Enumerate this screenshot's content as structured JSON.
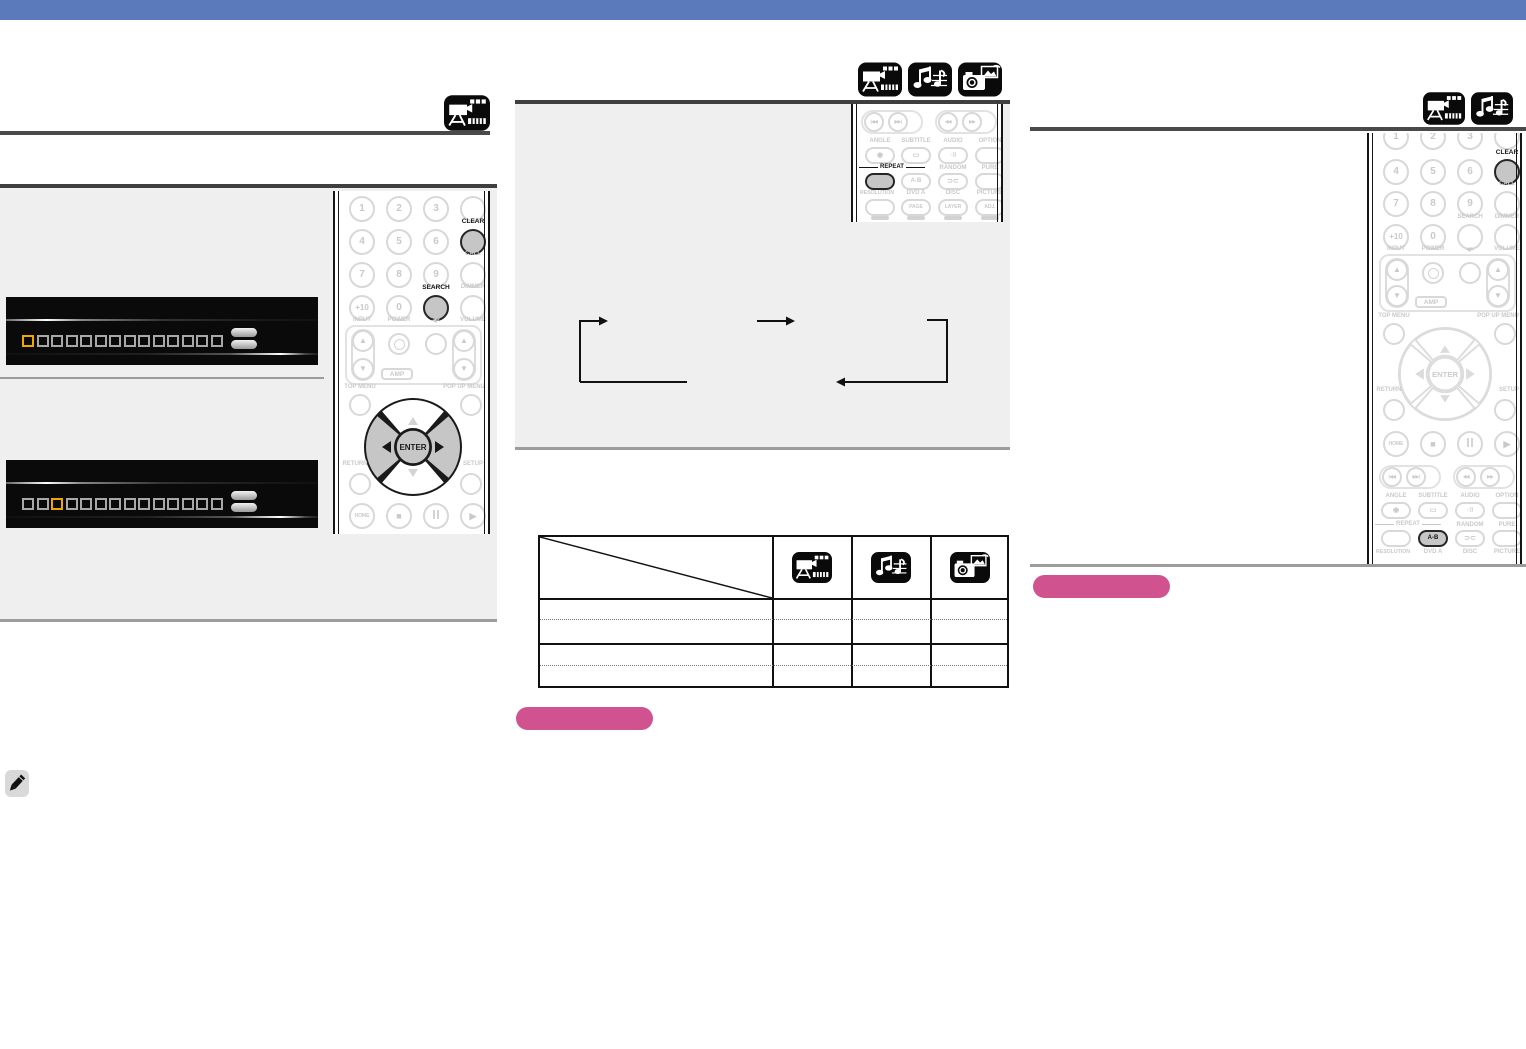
{
  "page": {
    "header_bar_color": "#5b7abc",
    "accent_pink": "#d0538f",
    "display_highlight_orange": "#f0a500"
  },
  "media_icons": {
    "left_section": [
      "dvd-video"
    ],
    "middle_section": [
      "dvd-video",
      "audio-cd",
      "picture"
    ],
    "right_section": [
      "dvd-video",
      "audio-cd"
    ]
  },
  "digits": [
    "1",
    "2",
    "3",
    "4",
    "5",
    "6",
    "7",
    "8",
    "9",
    "+10",
    "0"
  ],
  "remote_labels": {
    "clear": "CLEAR",
    "call": "CALL",
    "search": "SEARCH",
    "dimmer": "DIMMER",
    "input": "INPUT",
    "power": "POWER",
    "mute": "◀×",
    "volume": "VOLUME",
    "amp": "AMP",
    "top_menu": "TOP MENU",
    "popup_menu": "POP UP MENU",
    "enter": "ENTER",
    "return": "RETURN",
    "setup": "SETUP",
    "home": "HOME",
    "stop": "■",
    "play": "▶",
    "skip_back": "|◀◀",
    "skip_fwd": "▶▶|",
    "rew": "◀◀",
    "ffwd": "▶▶",
    "up": "▲",
    "down": "▼",
    "angle": "ANGLE",
    "subtitle": "SUBTITLE",
    "audio": "AUDIO",
    "option": "OPTION",
    "repeat": "REPEAT",
    "ab": "A-B",
    "random": "RANDOM",
    "pure": "PURE",
    "resolution": "RESOLUTION",
    "dvd_a": "DVD A",
    "disc": "DISC",
    "picture": "PICTURE",
    "page_btn": "PAGE",
    "layer": "LAYER",
    "adj": "ADJ.",
    "angle_glyph": "◉",
    "subtitle_glyph": "▭",
    "audio_glyph": "○))",
    "random_glyph": "⊃⊂"
  },
  "display_panels": [
    {
      "cells": 14,
      "highlight_index": 0
    },
    {
      "cells": 14,
      "highlight_index": 2
    }
  ],
  "table": {
    "header_icon_columns": [
      "dvd-video",
      "audio-cd",
      "picture"
    ],
    "body_row_count": 4
  }
}
